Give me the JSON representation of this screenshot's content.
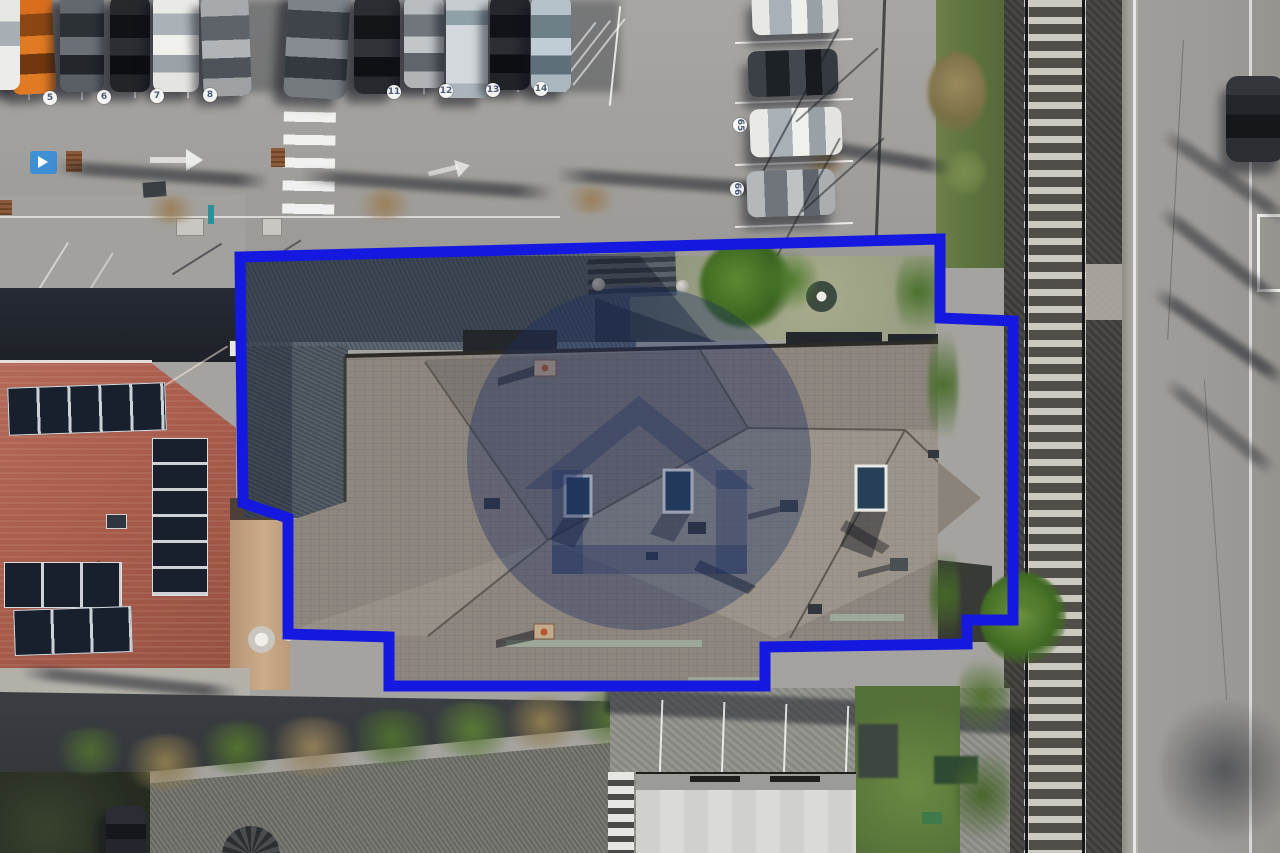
{
  "image": {
    "type": "aerial-drone-photograph",
    "description": "Top-down aerial photo of a large gray-roofed residential building outlined with a blue property boundary, beside a railway line, parking lot with numbered stalls, and a red-roofed building with solar panels",
    "width": 1280,
    "height": 853
  },
  "watermark": {
    "name": "agency-house-logo",
    "shape": "translucent navy circle containing a stylized house with open door",
    "color": "#1c2f60",
    "opacity": 0.38
  },
  "boundary": {
    "label": "property-outline",
    "color": "#1519e0",
    "stroke_width": 11,
    "points": "240,257 940,239 940,318 1013,321 1013,620 967,620 967,644 765,647 765,686 389,686 389,637 288,634 288,518 243,503"
  },
  "parking": {
    "spot_numbers": [
      "5",
      "6",
      "7",
      "8",
      "11",
      "12",
      "13",
      "14"
    ],
    "rotated_spot_numbers": [
      "65",
      "66"
    ],
    "top_row_car_colors": [
      "orange",
      "dark-gray",
      "black",
      "white",
      "silver",
      "dark-silver",
      "black",
      "silver",
      "white-van",
      "black-suv",
      "light-blue"
    ],
    "right_column_car_colors": [
      "white",
      "dark-gray",
      "white",
      "silver"
    ]
  },
  "features": {
    "railway": "double-rail track with ballast running vertically on right",
    "road_right": "asphalt road with white edge lines and parked dark car",
    "crosswalk": "white zebra stripes",
    "solar_panels": "three arrays on red tiled roof",
    "hedge": "green and dry shrubs along bottom walkway",
    "censored_area": "blurred privacy rectangle near bottom center"
  },
  "palette": {
    "boundary": "#1519e0",
    "watermark": "#1c2f60",
    "asphalt": "#a5a39f",
    "roof": "#8e8780",
    "redroof": "#a85c4c",
    "grass": "#5f7540",
    "ballast": "#44423e",
    "road": "#9d9b98"
  }
}
